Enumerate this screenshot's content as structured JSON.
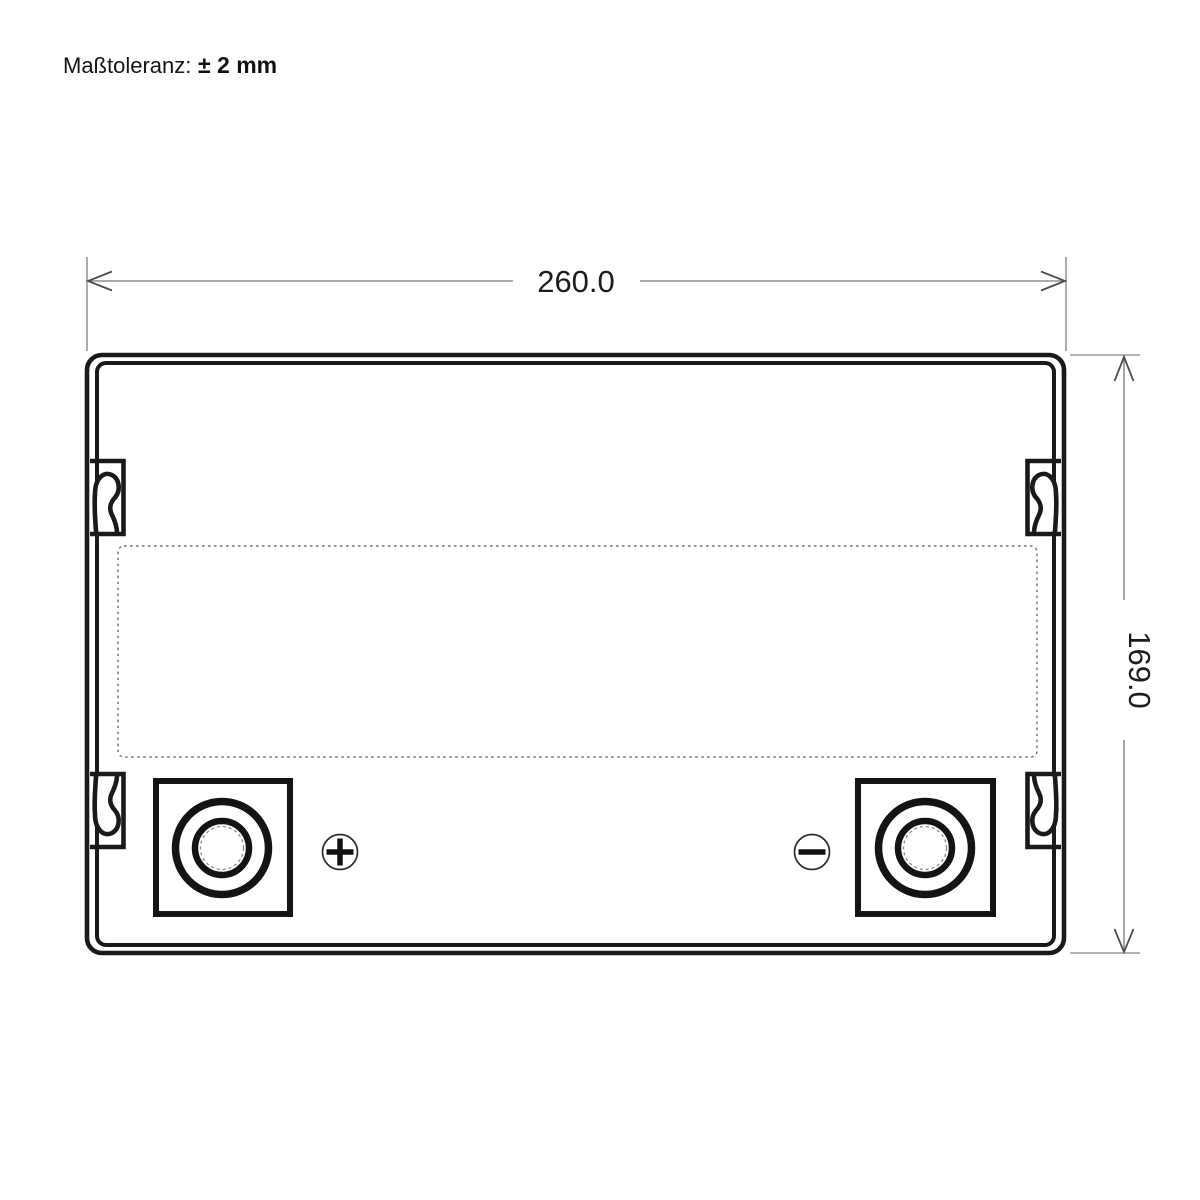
{
  "tolerance": {
    "label": "Maßtoleranz:",
    "value": "± 2 mm"
  },
  "dimensions": {
    "width": "260.0",
    "height": "169.0"
  },
  "terminals": {
    "positive": {
      "icon": "plus-icon",
      "symbol": "+"
    },
    "negative": {
      "icon": "minus-icon",
      "symbol": "−"
    }
  },
  "colors": {
    "drawing_line": "#1a1a1a",
    "dimension_line": "#8f8f8f",
    "arrow": "#4d4d4d",
    "dashed_outline": "#6e6e6e",
    "background": "#ffffff"
  }
}
